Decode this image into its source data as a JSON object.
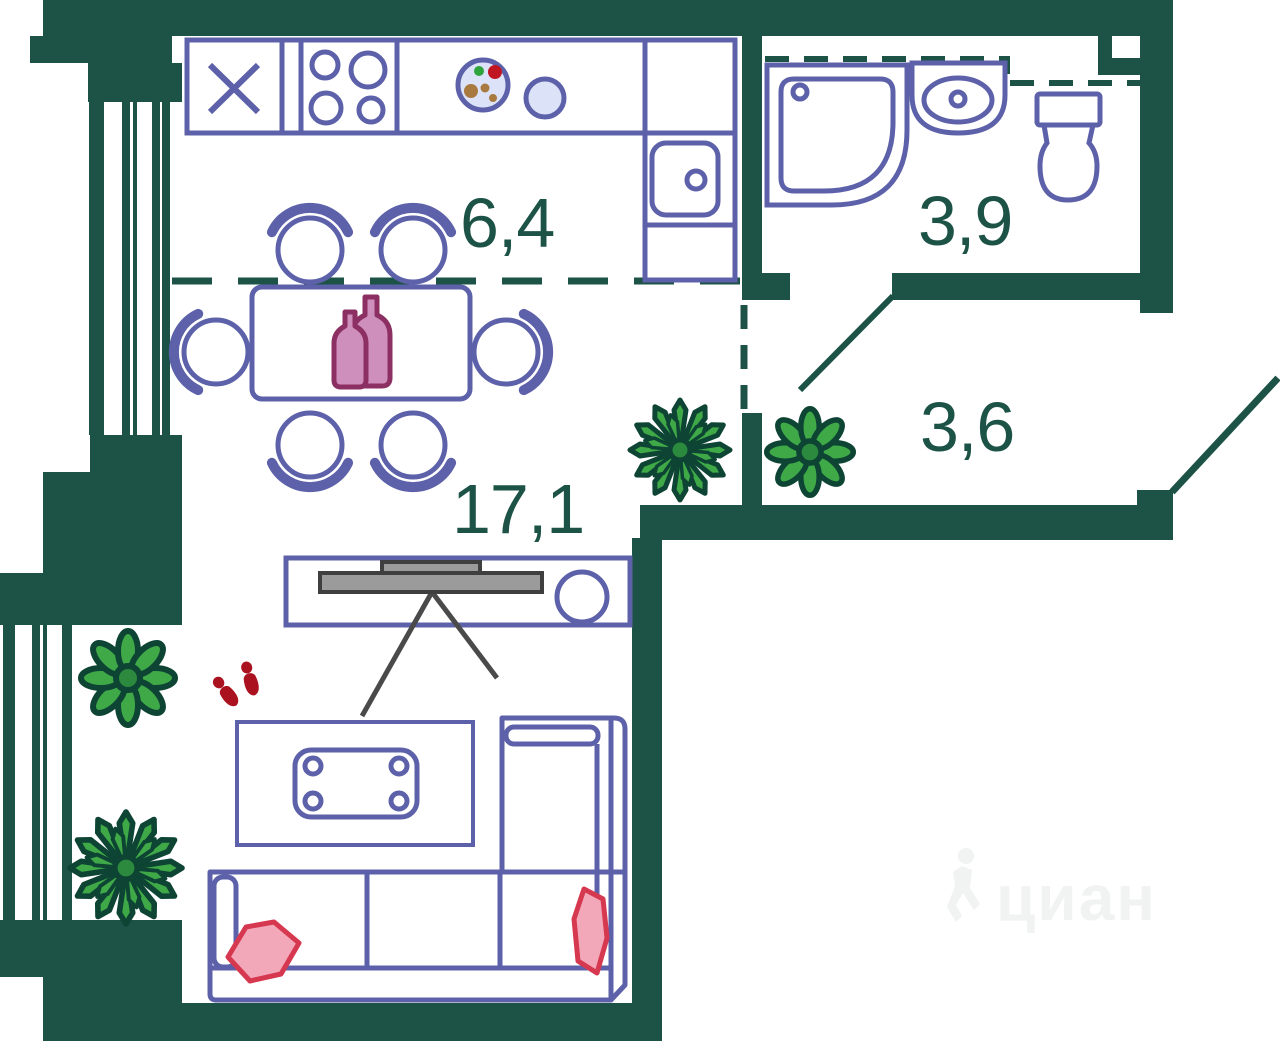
{
  "rooms": {
    "kitchen": {
      "area": "6,4"
    },
    "bathroom": {
      "area": "3,9"
    },
    "hall": {
      "area": "3,6"
    },
    "living": {
      "area": "17,1"
    }
  },
  "watermark": {
    "brand": "циан"
  },
  "colors": {
    "wall": "#1d5347",
    "label": "#1d5347",
    "furniture_outline": "#5c61a9",
    "light_blue_fill": "#dce3f8",
    "tv_gray": "#9b9b9b",
    "plant_green": "#3fa948",
    "plant_outline": "#0d4434",
    "bottle_pink": "#cf8fbd",
    "bottle_outline": "#8c2f62",
    "pillow_pink": "#f3a8ba",
    "pillow_outline": "#d63850",
    "slipper_red": "#ab1220",
    "watermark_gray": "#f1f2f2"
  }
}
